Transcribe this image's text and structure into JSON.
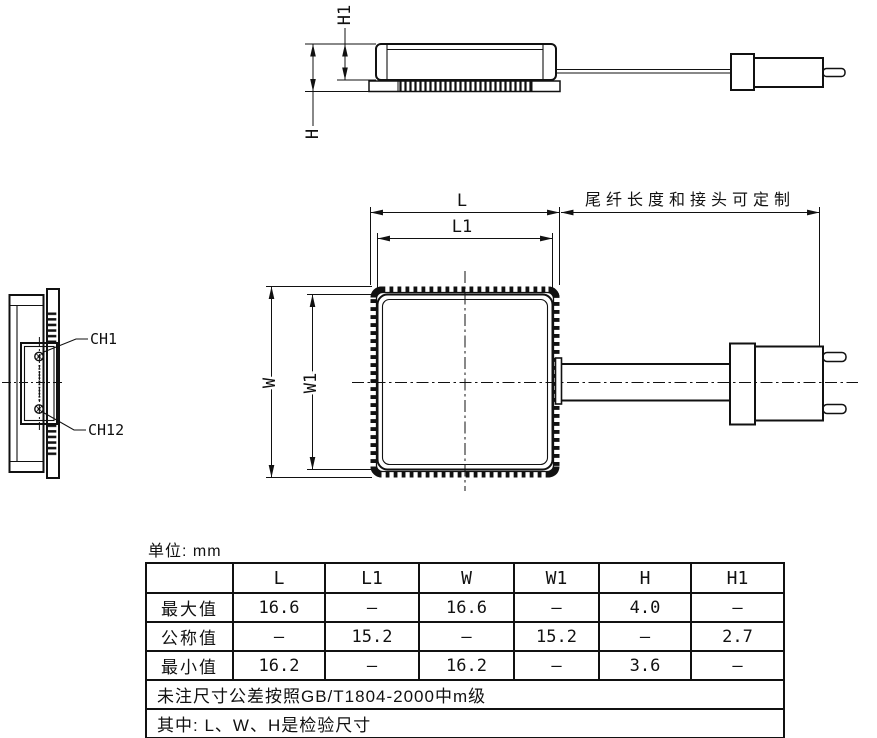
{
  "drawing": {
    "top_view": {
      "h_label": "H",
      "h1_label": "H1"
    },
    "plan_view": {
      "l_label": "L",
      "l1_label": "L1",
      "w_label": "W",
      "w1_label": "W1",
      "pigtail_note": "尾纤长度和接头可定制"
    },
    "side_view": {
      "ch1_label": "CH1",
      "ch12_label": "CH12"
    }
  },
  "units_label": "单位: mm",
  "table": {
    "header": [
      "",
      "L",
      "L1",
      "W",
      "W1",
      "H",
      "H1"
    ],
    "rows": [
      {
        "name": "最大值",
        "values": [
          "16.6",
          "—",
          "16.6",
          "—",
          "4.0",
          "—"
        ]
      },
      {
        "name": "公称值",
        "values": [
          "—",
          "15.2",
          "—",
          "15.2",
          "—",
          "2.7"
        ]
      },
      {
        "name": "最小值",
        "values": [
          "16.2",
          "—",
          "16.2",
          "—",
          "3.6",
          "—"
        ]
      }
    ],
    "notes": [
      "未注尺寸公差按照GB/T1804-2000中m级",
      "其中: L、W、H是检验尺寸"
    ]
  },
  "colors": {
    "line": "#111111",
    "background": "#ffffff"
  }
}
